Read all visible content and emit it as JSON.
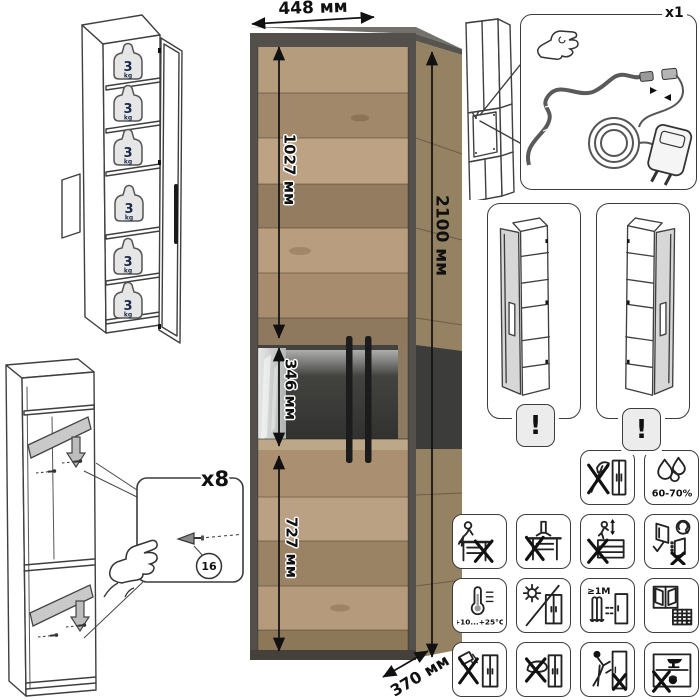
{
  "dimensions": {
    "width": "448 мм",
    "height": "2100 мм",
    "top_section_height": "1027 мм",
    "middle_section_height": "346 мм",
    "bottom_section_height": "727 мм",
    "depth": "370 мм"
  },
  "shelf_load": {
    "value": "3",
    "unit": "kg"
  },
  "led_kit": {
    "quantity": "x1"
  },
  "shelf_pins": {
    "quantity": "x8",
    "part_number": "16"
  },
  "door_variants": {
    "warning_mark": "!"
  },
  "care_pictograms": {
    "humidity_range": "60-70%",
    "temperature_range": "+10...+25°C",
    "heater_distance": "≥1M",
    "calendar_day": "21",
    "icon_names": [
      "no-sharp-tools-icon",
      "humidity-icon",
      "no-sitting-icon",
      "no-standing-icon",
      "no-climbing-icon",
      "door-adjustment-icon",
      "temperature-range-icon",
      "no-direct-sunlight-icon",
      "heater-distance-icon",
      "ventilation-calendar-icon",
      "no-spilling-liquids-icon",
      "no-abrasive-cleaning-icon",
      "no-dragging-icon",
      "no-heavy-items-icon"
    ]
  },
  "colors": {
    "wood": "#b2987a",
    "frame_graphite": "#53504b",
    "interior_dark": "#3a3a38",
    "line_art": "#3f3f3f",
    "shelf_gray": "#c9c9c9"
  }
}
